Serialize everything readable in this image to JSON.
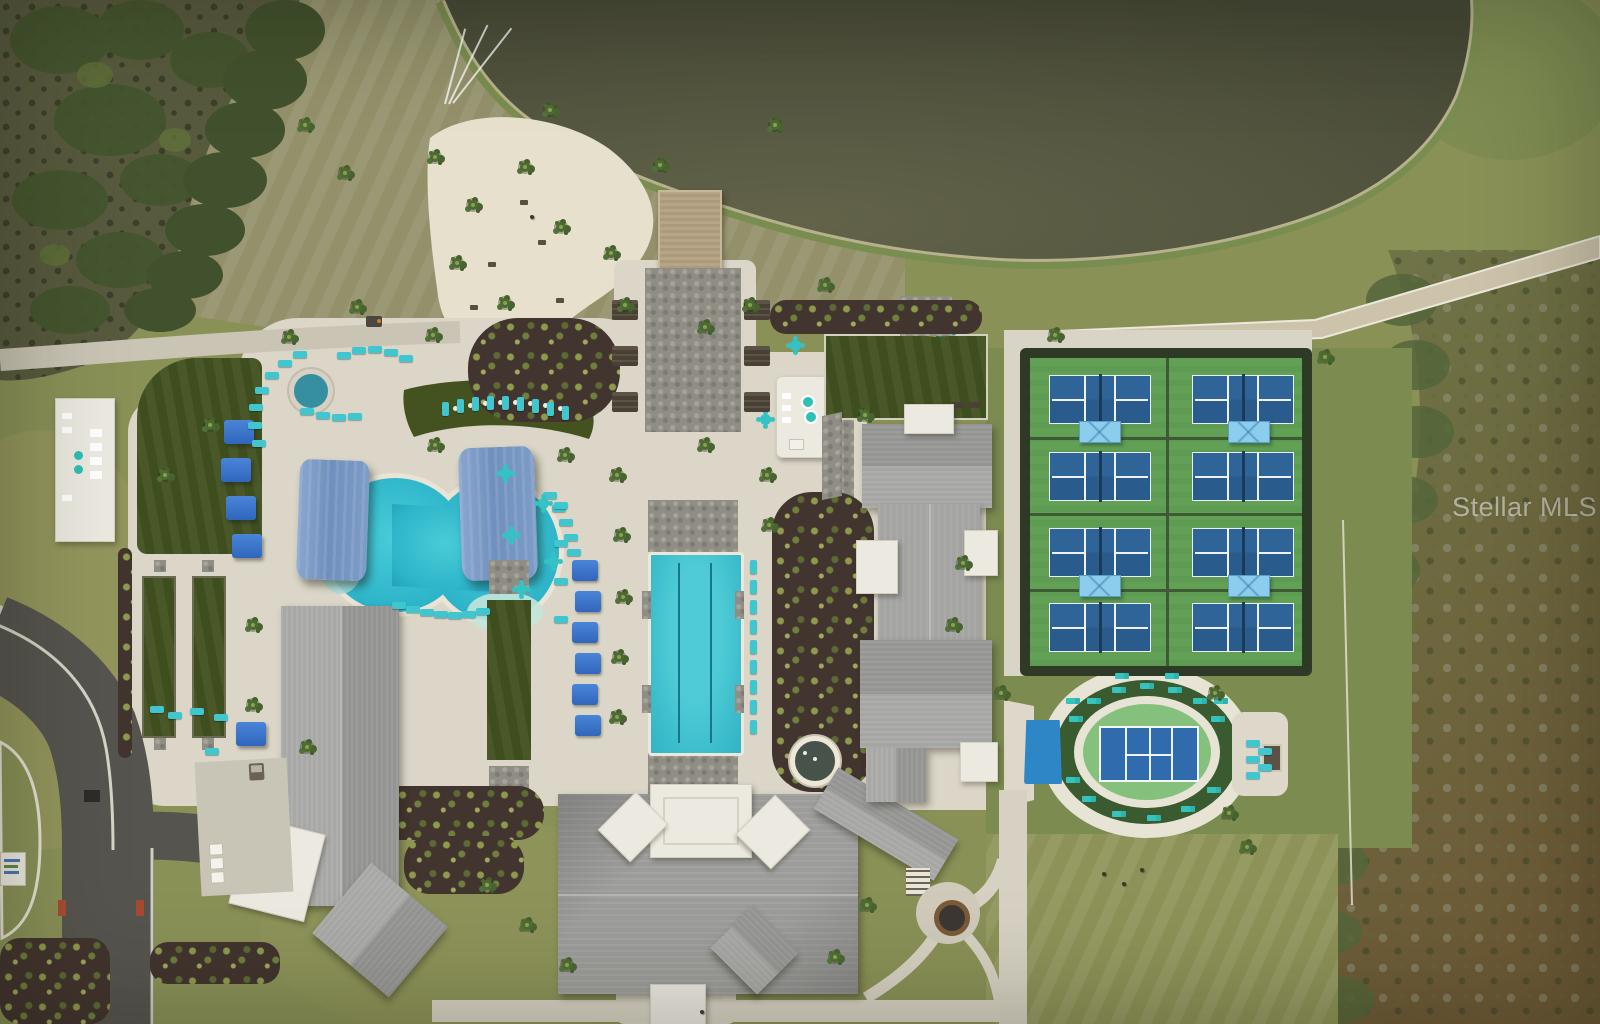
{
  "watermark": {
    "text": "Stellar MLS"
  },
  "scene": {
    "type": "aerial-drone-photo",
    "setting": "lakefront community amenity campus bordered by marsh preserve",
    "palette": {
      "lake": "#53553f",
      "grass": "#8a9157",
      "dry_field": "#93906a",
      "marsh_dark": "#585a3e",
      "scrub_brown": "#6d5a36",
      "sand_beach": "#e6e0cd",
      "pool_deck": "#dbd6c7",
      "pool_water": "#2db4c9",
      "lap_pool_water": "#38c0cd",
      "shade_sail_blue": "#7a9ac6",
      "cabana_blue": "#3c79cf",
      "lounger_teal": "#3fc6cf",
      "turf_dark_green": "#3f4e1e",
      "pickleball_green": "#61a055",
      "pickleball_court_blue": "#2b5f92",
      "court_canopy_blue": "#8ccdee",
      "stadium_infield_green": "#85c17d",
      "roof_gray": "#9c9c9a",
      "roof_white": "#ebe9e0",
      "asphalt": "#56544e",
      "concrete_path": "#cfcaba"
    },
    "amenities": {
      "pickleball_courts": {
        "count": 8,
        "shade_canopies": 4
      },
      "stadium_court": {
        "courts": 1,
        "side_canopies": 1
      },
      "resort_pool": {
        "shade_sails": 2,
        "round_spas": 2
      },
      "lap_pool": {
        "marked_lanes": 2,
        "daybeds": 6
      },
      "bocce_courts": {
        "count": 2
      },
      "event_lawns": {
        "count": 2
      },
      "beach_with_palms": true,
      "lake_dock": {
        "count": 1
      },
      "fire_pit": {
        "count": 1
      }
    }
  }
}
